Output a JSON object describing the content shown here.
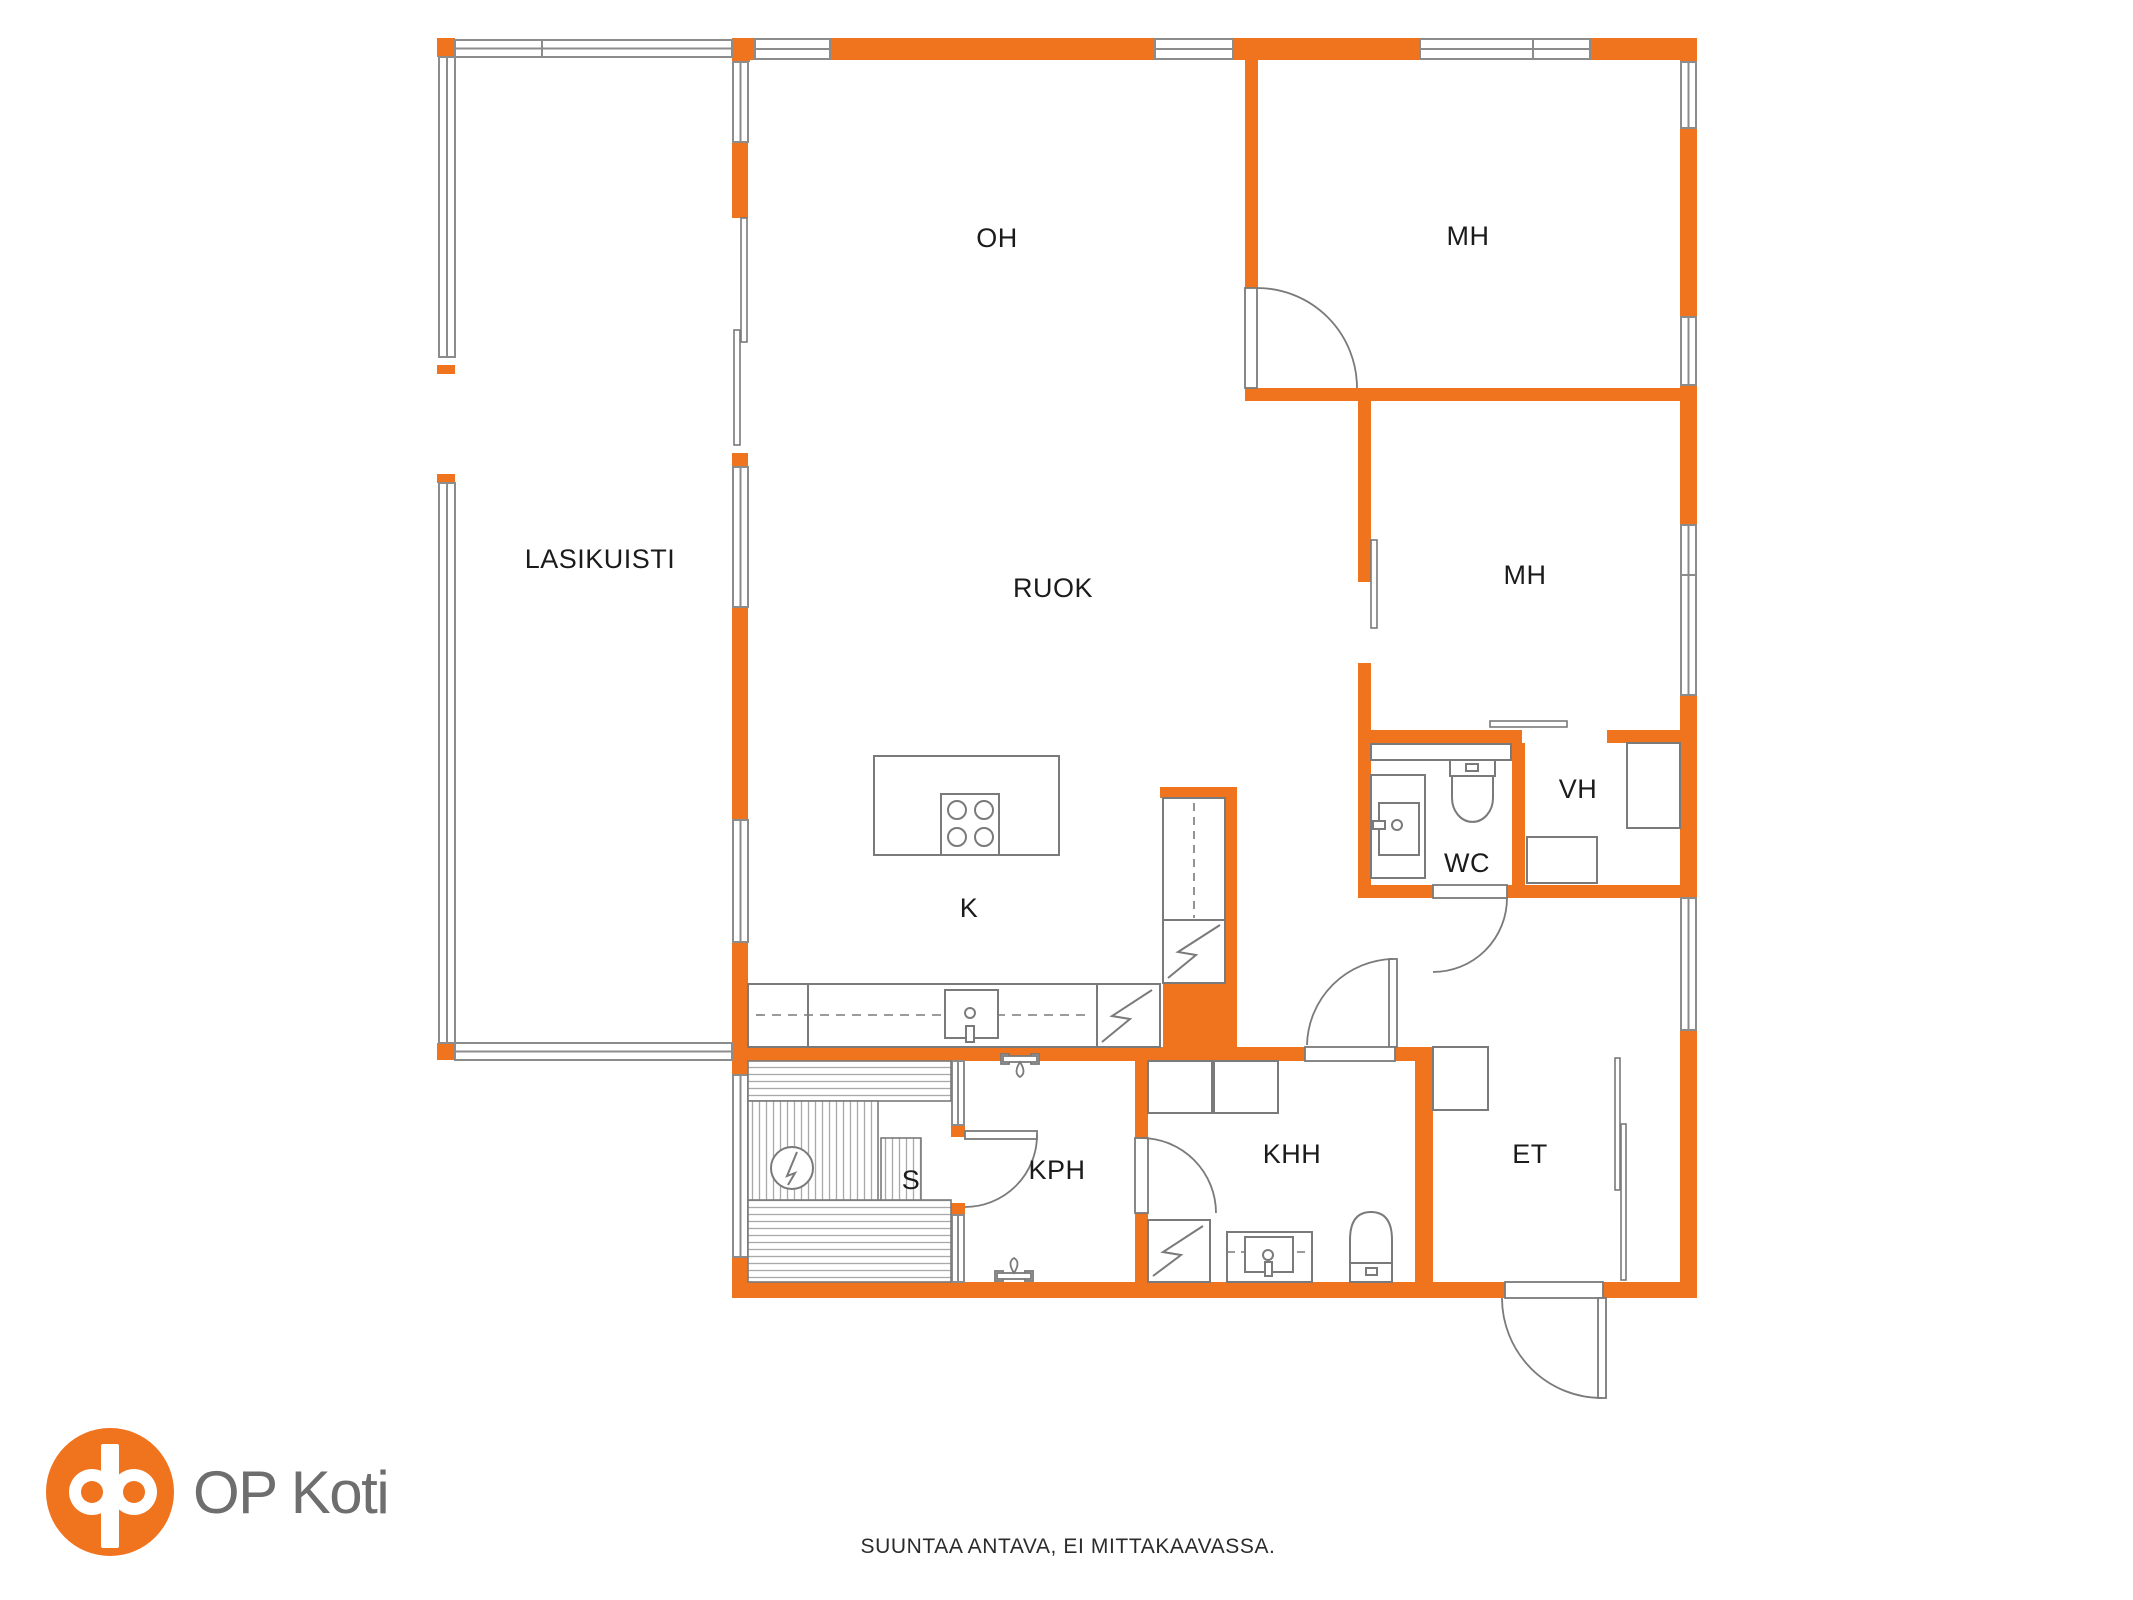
{
  "floorplan": {
    "rooms": {
      "lasikuisti": "LASIKUISTI",
      "oh": "OH",
      "mh_top": "MH",
      "ruok": "RUOK",
      "mh_mid": "MH",
      "vh": "VH",
      "wc": "WC",
      "k": "K",
      "s": "S",
      "kph": "KPH",
      "khh": "KHH",
      "et": "ET"
    },
    "caption": "SUUNTAA ANTAVA, EI MITTAKAAVASSA.",
    "colors": {
      "wall_orange": "#F0731E",
      "fixture_line_gray": "#7a7a7a",
      "window_frame_gray": "#8c8c8c",
      "label_text": "#1b1b1b",
      "logo_text_gray": "#6e6e6e"
    }
  },
  "branding": {
    "logo_text": "OP Koti"
  }
}
